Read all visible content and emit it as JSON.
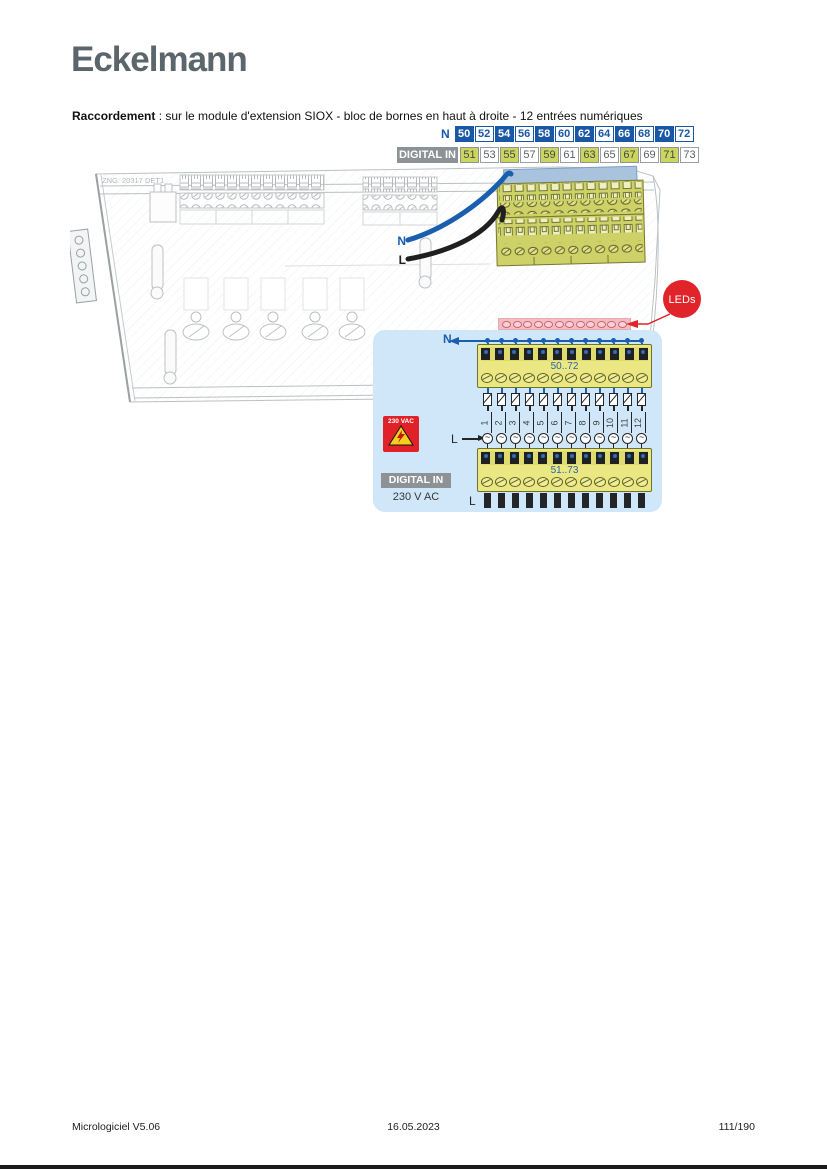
{
  "page": {
    "logo": "Eckelmann",
    "heading_bold": "Raccordement",
    "heading_rest": " : sur le module d'extension SIOX - bloc de bornes en haut à droite - 12 entrées numériques",
    "footer": {
      "left": "Micrologiciel V5.06",
      "center": "16.05.2023",
      "right": "111/190"
    }
  },
  "terminal_map": {
    "n_label": "N",
    "digital_in_label": "DIGITAL IN",
    "n_row": [
      {
        "label": "50",
        "variant": "filled"
      },
      {
        "label": "52",
        "variant": "outline"
      },
      {
        "label": "54",
        "variant": "filled"
      },
      {
        "label": "56",
        "variant": "outline"
      },
      {
        "label": "58",
        "variant": "filled"
      },
      {
        "label": "60",
        "variant": "outline"
      },
      {
        "label": "62",
        "variant": "filled"
      },
      {
        "label": "64",
        "variant": "outline"
      },
      {
        "label": "66",
        "variant": "filled"
      },
      {
        "label": "68",
        "variant": "outline"
      },
      {
        "label": "70",
        "variant": "filled"
      },
      {
        "label": "72",
        "variant": "outline"
      }
    ],
    "digital_row": [
      {
        "label": "51",
        "variant": "yellow"
      },
      {
        "label": "53",
        "variant": "white"
      },
      {
        "label": "55",
        "variant": "yellow"
      },
      {
        "label": "57",
        "variant": "white"
      },
      {
        "label": "59",
        "variant": "yellow"
      },
      {
        "label": "61",
        "variant": "white"
      },
      {
        "label": "63",
        "variant": "yellow"
      },
      {
        "label": "65",
        "variant": "white"
      },
      {
        "label": "67",
        "variant": "yellow"
      },
      {
        "label": "69",
        "variant": "white"
      },
      {
        "label": "71",
        "variant": "yellow"
      },
      {
        "label": "73",
        "variant": "white"
      }
    ]
  },
  "module": {
    "drawing_note": "ZNG: 20317 DET1",
    "wire_n_label": "N",
    "wire_l_label": "L"
  },
  "callout": {
    "leds_label": "LEDs"
  },
  "detail": {
    "n_label": "N",
    "l_label": "L",
    "l_bottom_label": "L",
    "top_block_label": "50..72",
    "bottom_block_label": "51..73",
    "channel_numbers": [
      "1",
      "2",
      "3",
      "4",
      "5",
      "6",
      "7",
      "8",
      "9",
      "10",
      "11",
      "12"
    ],
    "warning_label": "230 VAC",
    "digital_in_label": "DIGITAL IN",
    "voltage_label": "230 V AC",
    "ac_symbol": "~"
  },
  "icons": {
    "ac_source": "~",
    "warning_triangle": "lightning-bolt"
  },
  "colors": {
    "accent_blue": "#1a57a5",
    "wire_blue": "#1a5fae",
    "terminal_yellow": "#ccd65e",
    "block_yellow": "#ebe884",
    "panel_blue": "#cfe7f8",
    "led_red": "#e1232a",
    "led_strip_pink": "#f4bcc1",
    "badge_gray": "#8d9296",
    "logo_gray": "#5b656c"
  }
}
